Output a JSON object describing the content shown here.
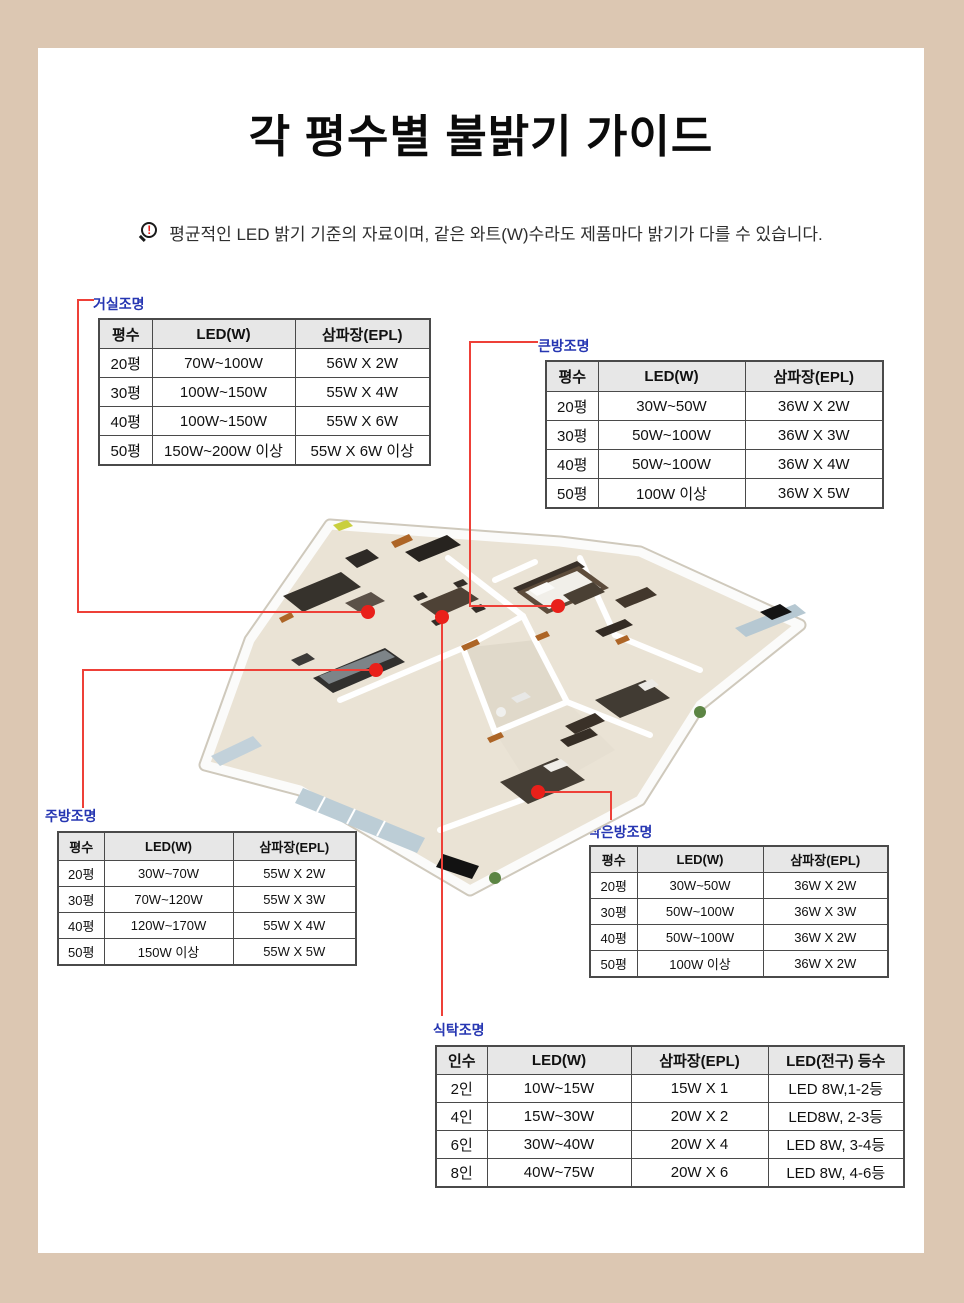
{
  "page": {
    "title": "각 평수별 불밝기 가이드",
    "notice": "평균적인 LED 밝기 기준의 자료이며, 같은 와트(W)수라도 제품마다 밝기가 다를 수 있습니다.",
    "notice_icon": "magnifier-exclamation-icon",
    "notice_icon_glyph": "!"
  },
  "palette": {
    "background": "#dcc7b2",
    "panel": "#ffffff",
    "label_blue": "#2636b2",
    "callout_line_red": "#ee4038",
    "callout_dot_red": "#e9201a",
    "table_header_bg": "#e7e7e7",
    "table_border": "#4a4a4a",
    "floor_fill": "#eae3d5"
  },
  "tables": {
    "living": {
      "label": "거실조명",
      "headers": [
        "평수",
        "LED(W)",
        "삼파장(EPL)"
      ],
      "rows": [
        [
          "20평",
          "70W~100W",
          "56W X 2W"
        ],
        [
          "30평",
          "100W~150W",
          "55W X 4W"
        ],
        [
          "40평",
          "100W~150W",
          "55W X 6W"
        ],
        [
          "50평",
          "150W~200W 이상",
          "55W X 6W 이상"
        ]
      ]
    },
    "big_room": {
      "label": "큰방조명",
      "headers": [
        "평수",
        "LED(W)",
        "삼파장(EPL)"
      ],
      "rows": [
        [
          "20평",
          "30W~50W",
          "36W X 2W"
        ],
        [
          "30평",
          "50W~100W",
          "36W X 3W"
        ],
        [
          "40평",
          "50W~100W",
          "36W X 4W"
        ],
        [
          "50평",
          "100W 이상",
          "36W X 5W"
        ]
      ]
    },
    "kitchen": {
      "label": "주방조명",
      "headers": [
        "평수",
        "LED(W)",
        "삼파장(EPL)"
      ],
      "rows": [
        [
          "20평",
          "30W~70W",
          "55W X 2W"
        ],
        [
          "30평",
          "70W~120W",
          "55W X 3W"
        ],
        [
          "40평",
          "120W~170W",
          "55W X 4W"
        ],
        [
          "50평",
          "150W 이상",
          "55W X 5W"
        ]
      ]
    },
    "small_room": {
      "label": "작은방조명",
      "headers": [
        "평수",
        "LED(W)",
        "삼파장(EPL)"
      ],
      "rows": [
        [
          "20평",
          "30W~50W",
          "36W X 2W"
        ],
        [
          "30평",
          "50W~100W",
          "36W X 3W"
        ],
        [
          "40평",
          "50W~100W",
          "36W X 2W"
        ],
        [
          "50평",
          "100W 이상",
          "36W X 2W"
        ]
      ]
    },
    "dining": {
      "label": "식탁조명",
      "headers": [
        "인수",
        "LED(W)",
        "삼파장(EPL)",
        "LED(전구) 등수"
      ],
      "rows": [
        [
          "2인",
          "10W~15W",
          "15W X 1",
          "LED 8W,1-2등"
        ],
        [
          "4인",
          "15W~30W",
          "20W X 2",
          "LED8W, 2-3등"
        ],
        [
          "6인",
          "30W~40W",
          "20W X 4",
          "LED 8W, 3-4등"
        ],
        [
          "8인",
          "40W~75W",
          "20W X 6",
          "LED 8W, 4-6등"
        ]
      ]
    }
  }
}
